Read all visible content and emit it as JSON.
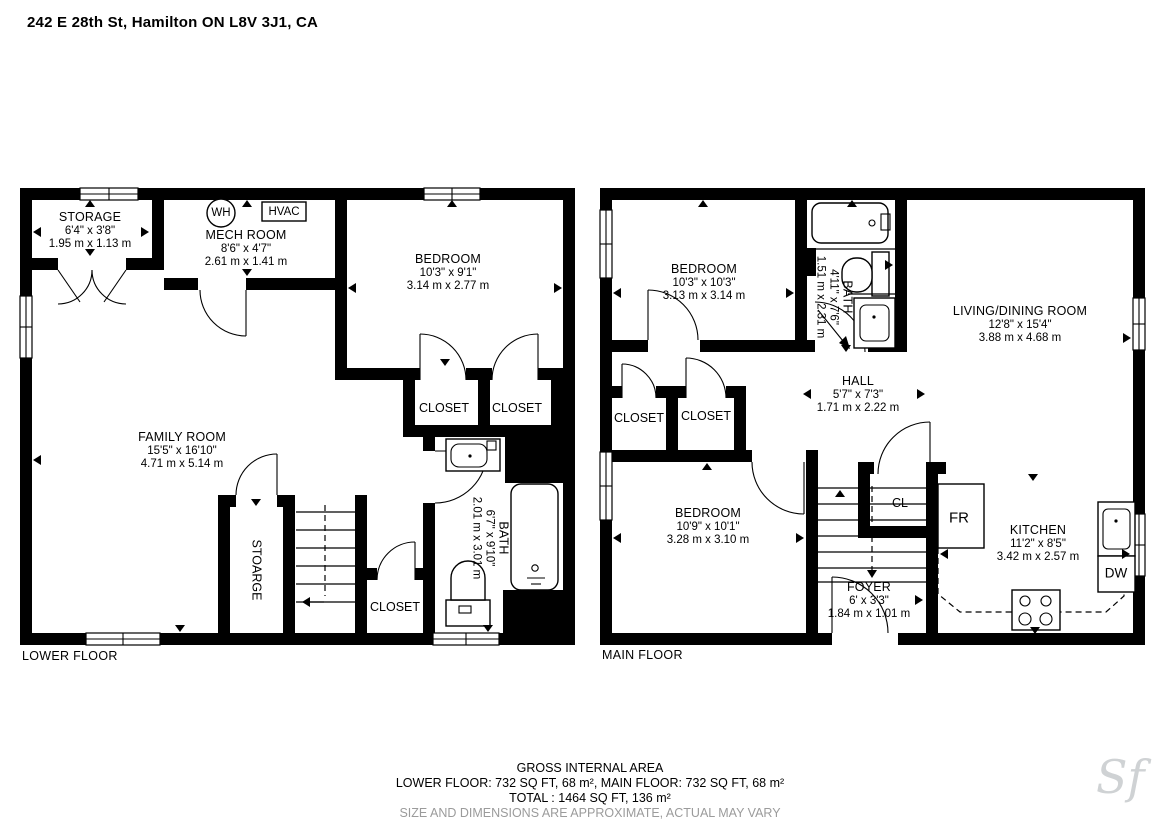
{
  "title": "242 E 28th St, Hamilton ON L8V 3J1, CA",
  "floors": {
    "lower": {
      "label": "LOWER FLOOR",
      "rooms": {
        "storage": {
          "name": "STORAGE",
          "ft": "6'4\" x 3'8\"",
          "m": "1.95 m x 1.13 m"
        },
        "mech": {
          "name": "MECH ROOM",
          "ft": "8'6\" x 4'7\"",
          "m": "2.61 m x 1.41 m"
        },
        "bedroom": {
          "name": "BEDROOM",
          "ft": "10'3\" x 9'1\"",
          "m": "3.14 m x 2.77 m"
        },
        "family": {
          "name": "FAMILY ROOM",
          "ft": "15'5\" x 16'10\"",
          "m": "4.71 m x 5.14 m"
        },
        "bath": {
          "name": "BATH",
          "ft": "6'7\" x 9'10\"",
          "m": "2.01 m x 3.01 m"
        },
        "closet_a": "CLOSET",
        "closet_b": "CLOSET",
        "closet_c": "CLOSET",
        "storage2": "STOARGE"
      },
      "fixtures": {
        "wh": "WH",
        "hvac": "HVAC"
      }
    },
    "main": {
      "label": "MAIN FLOOR",
      "rooms": {
        "bedroom1": {
          "name": "BEDROOM",
          "ft": "10'3\" x 10'3\"",
          "m": "3.13 m x 3.14 m"
        },
        "bath": {
          "name": "BATH",
          "ft": "4'11\" x 7'6\"",
          "m": "1.51 m x 2.31 m"
        },
        "living": {
          "name": "LIVING/DINING ROOM",
          "ft": "12'8\" x 15'4\"",
          "m": "3.88 m x 4.68 m"
        },
        "hall": {
          "name": "HALL",
          "ft": "5'7\" x 7'3\"",
          "m": "1.71 m x 2.22 m"
        },
        "bedroom2": {
          "name": "BEDROOM",
          "ft": "10'9\" x 10'1\"",
          "m": "3.28 m x 3.10 m"
        },
        "kitchen": {
          "name": "KITCHEN",
          "ft": "11'2\" x 8'5\"",
          "m": "3.42 m x 2.57 m"
        },
        "foyer": {
          "name": "FOYER",
          "ft": "6' x 3'3\"",
          "m": "1.84 m x 1.01 m"
        },
        "closet_a": "CLOSET",
        "closet_b": "CLOSET",
        "cl": "CL"
      },
      "fixtures": {
        "fr": "FR",
        "dw": "DW"
      }
    }
  },
  "footer": {
    "heading": "GROSS INTERNAL AREA",
    "areas": "LOWER FLOOR: 732 SQ FT, 68 m², MAIN FLOOR: 732 SQ FT, 68 m²",
    "total": "TOTAL : 1464 SQ FT, 136 m²",
    "disclaimer": "SIZE AND DIMENSIONS ARE APPROXIMATE, ACTUAL MAY VARY"
  },
  "watermark": "Sf"
}
